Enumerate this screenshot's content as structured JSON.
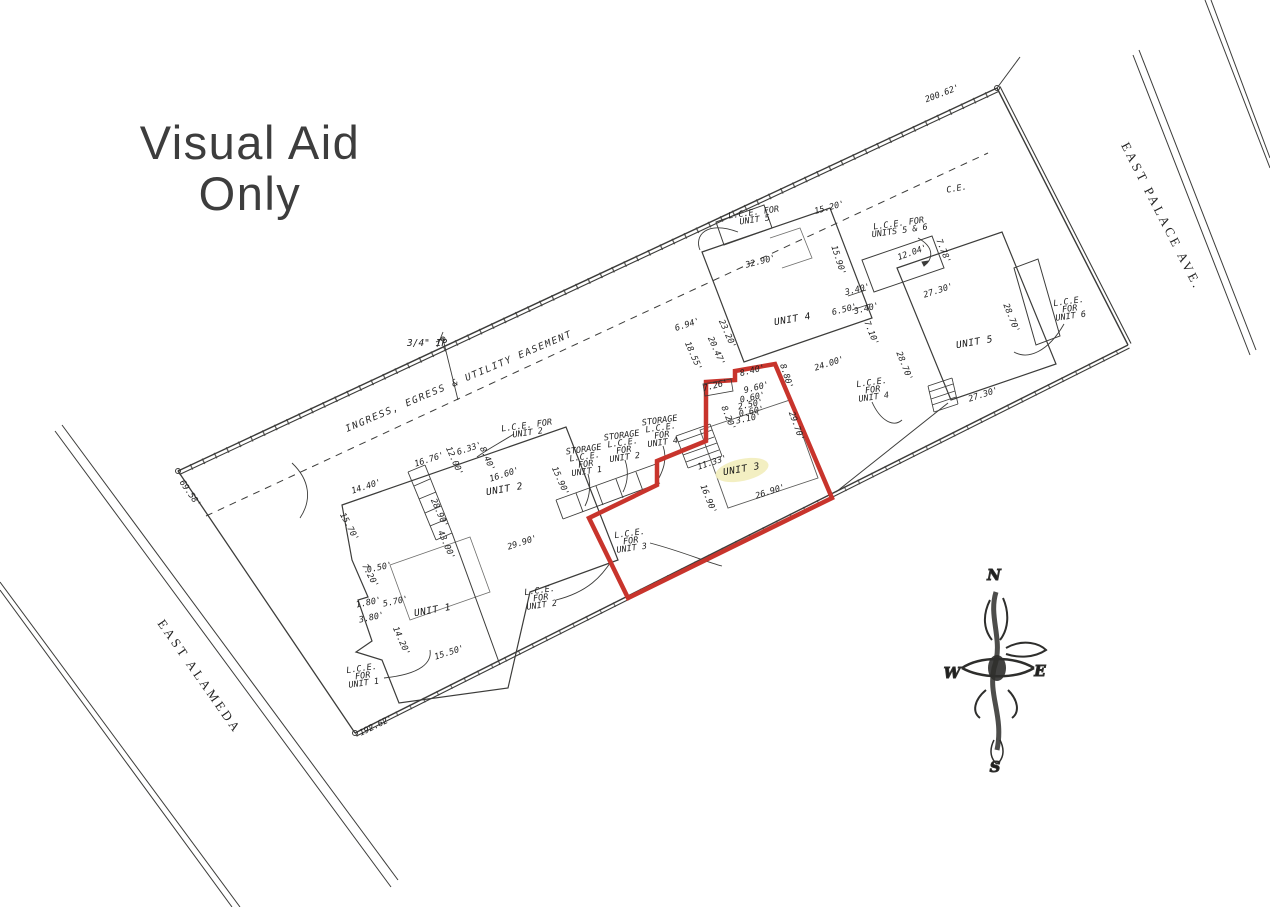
{
  "title": {
    "line1": "Visual Aid",
    "line2": "Only"
  },
  "streets": {
    "palace": "EAST PALACE AVE.",
    "alameda": "EAST ALAMEDA"
  },
  "labels": {
    "easement": "INGRESS, EGRESS & UTILITY EASEMENT",
    "ip_marker": "3/4\" IP"
  },
  "compass": {
    "n": "N",
    "e": "E",
    "s": "S",
    "w": "W"
  },
  "colors": {
    "unit3_outline": "#c8342c",
    "unit3_highlight": "#f2edbb",
    "ink": "#3c3c3a"
  },
  "plan": {
    "units": [
      {
        "t": "UNIT 1",
        "x": 433,
        "y": 613,
        "r": -10,
        "hl": false
      },
      {
        "t": "UNIT 2",
        "x": 505,
        "y": 492,
        "r": -10,
        "hl": false
      },
      {
        "t": "UNIT 3",
        "x": 742,
        "y": 472,
        "r": -10,
        "hl": true
      },
      {
        "t": "UNIT 4",
        "x": 793,
        "y": 322,
        "r": -10,
        "hl": false
      },
      {
        "t": "UNIT 5",
        "x": 975,
        "y": 345,
        "r": -10,
        "hl": false
      }
    ],
    "lce_labels": [
      {
        "lines": [
          "L.C.E. FOR",
          "UNIT 5"
        ],
        "x": 754,
        "y": 215,
        "r": -8
      },
      {
        "lines": [
          "L.C.E. FOR",
          "UNITS 5 & 6"
        ],
        "x": 899,
        "y": 226,
        "r": -8
      },
      {
        "lines": [
          "L.C.E.",
          "FOR",
          "UNIT 6"
        ],
        "x": 1069,
        "y": 304,
        "r": -8
      },
      {
        "lines": [
          "L.C.E.",
          "FOR",
          "UNIT 4"
        ],
        "x": 872,
        "y": 385,
        "r": -8
      },
      {
        "lines": [
          "STORAGE",
          "L.C.E.",
          "FOR",
          "UNIT 4"
        ],
        "x": 660,
        "y": 423,
        "r": -8
      },
      {
        "lines": [
          "STORAGE",
          "L.C.E.",
          "FOR",
          "UNIT 2"
        ],
        "x": 622,
        "y": 438,
        "r": -8
      },
      {
        "lines": [
          "STORAGE",
          "L.C.E.",
          "FOR",
          "UNIT 1"
        ],
        "x": 584,
        "y": 452,
        "r": -8
      },
      {
        "lines": [
          "L.C.E.",
          "FOR",
          "UNIT 3"
        ],
        "x": 630,
        "y": 536,
        "r": -8
      },
      {
        "lines": [
          "L.C.E.",
          "FOR",
          "UNIT 2"
        ],
        "x": 540,
        "y": 593,
        "r": -8
      },
      {
        "lines": [
          "L.C.E.",
          "FOR",
          "UNIT 1"
        ],
        "x": 362,
        "y": 671,
        "r": -8
      },
      {
        "lines": [
          "L.C.E. FOR",
          "UNIT 2"
        ],
        "x": 527,
        "y": 428,
        "r": -8
      }
    ],
    "annotations": [
      {
        "t": "200.62'",
        "x": 943,
        "y": 96,
        "r": -21
      },
      {
        "t": "C.E.",
        "x": 957,
        "y": 191,
        "r": -10
      },
      {
        "t": "15.20'",
        "x": 830,
        "y": 210,
        "r": -15
      },
      {
        "t": "32.90'",
        "x": 761,
        "y": 264,
        "r": -14
      },
      {
        "t": "15.90'",
        "x": 836,
        "y": 261,
        "r": 72
      },
      {
        "t": "12.04'",
        "x": 913,
        "y": 255,
        "r": -20
      },
      {
        "t": "7.78'",
        "x": 941,
        "y": 252,
        "r": 68
      },
      {
        "t": "27.30'",
        "x": 939,
        "y": 293,
        "r": -18
      },
      {
        "t": "3.40'",
        "x": 858,
        "y": 292,
        "r": -14
      },
      {
        "t": "6.50'",
        "x": 845,
        "y": 312,
        "r": -14
      },
      {
        "t": "3.40'",
        "x": 867,
        "y": 311,
        "r": -14
      },
      {
        "t": "7.10'",
        "x": 869,
        "y": 334,
        "r": 68
      },
      {
        "t": "28.70'",
        "x": 1009,
        "y": 319,
        "r": 68
      },
      {
        "t": "27.30'",
        "x": 984,
        "y": 397,
        "r": -18
      },
      {
        "t": "28.70'",
        "x": 902,
        "y": 367,
        "r": 68
      },
      {
        "t": "24.00'",
        "x": 830,
        "y": 366,
        "r": -18
      },
      {
        "t": "23.20'",
        "x": 725,
        "y": 335,
        "r": 66
      },
      {
        "t": "6.94'",
        "x": 688,
        "y": 327,
        "r": -18
      },
      {
        "t": "20.47'",
        "x": 714,
        "y": 352,
        "r": 66
      },
      {
        "t": "18.55'",
        "x": 691,
        "y": 357,
        "r": 66
      },
      {
        "t": "8.40'",
        "x": 753,
        "y": 373,
        "r": -14
      },
      {
        "t": "8.80'",
        "x": 784,
        "y": 377,
        "r": 72
      },
      {
        "t": "9.60'",
        "x": 757,
        "y": 390,
        "r": -14
      },
      {
        "t": "7.26'",
        "x": 716,
        "y": 388,
        "r": -14
      },
      {
        "t": "0.60'",
        "x": 753,
        "y": 400,
        "r": -12
      },
      {
        "t": "2.50'",
        "x": 751,
        "y": 407,
        "r": -12
      },
      {
        "t": "0.60'",
        "x": 752,
        "y": 414,
        "r": -12
      },
      {
        "t": "3.10'",
        "x": 749,
        "y": 421,
        "r": -12
      },
      {
        "t": "8.20'",
        "x": 726,
        "y": 419,
        "r": 68
      },
      {
        "t": "29.70'",
        "x": 794,
        "y": 427,
        "r": 70
      },
      {
        "t": "11.33'",
        "x": 713,
        "y": 465,
        "r": -18
      },
      {
        "t": "16.90'",
        "x": 706,
        "y": 500,
        "r": 68
      },
      {
        "t": "26.90'",
        "x": 771,
        "y": 494,
        "r": -18
      },
      {
        "t": "14.40'",
        "x": 367,
        "y": 489,
        "r": -18
      },
      {
        "t": "15.70'",
        "x": 347,
        "y": 528,
        "r": 62
      },
      {
        "t": "16.76'",
        "x": 430,
        "y": 462,
        "r": -18
      },
      {
        "t": "12.00'",
        "x": 452,
        "y": 462,
        "r": 66
      },
      {
        "t": "6.33'",
        "x": 470,
        "y": 451,
        "r": -18
      },
      {
        "t": "8.40'",
        "x": 485,
        "y": 460,
        "r": 66
      },
      {
        "t": "16.60'",
        "x": 505,
        "y": 477,
        "r": -18
      },
      {
        "t": "15.90'",
        "x": 558,
        "y": 482,
        "r": 66
      },
      {
        "t": "28.90'",
        "x": 437,
        "y": 514,
        "r": 66
      },
      {
        "t": "43.00'",
        "x": 444,
        "y": 546,
        "r": 66
      },
      {
        "t": "29.90'",
        "x": 523,
        "y": 545,
        "r": -18
      },
      {
        "t": "0.50'",
        "x": 380,
        "y": 570,
        "r": -12
      },
      {
        "t": "7.20'",
        "x": 368,
        "y": 577,
        "r": 62
      },
      {
        "t": "1.80'",
        "x": 369,
        "y": 605,
        "r": -12
      },
      {
        "t": "5.70'",
        "x": 396,
        "y": 604,
        "r": -12
      },
      {
        "t": "3.80'",
        "x": 372,
        "y": 620,
        "r": -12
      },
      {
        "t": "14.20'",
        "x": 399,
        "y": 642,
        "r": 66
      },
      {
        "t": "15.50'",
        "x": 450,
        "y": 655,
        "r": -18
      },
      {
        "t": "192.62'",
        "x": 377,
        "y": 728,
        "r": -26
      },
      {
        "t": "69.58'",
        "x": 188,
        "y": 495,
        "r": 55
      }
    ]
  }
}
